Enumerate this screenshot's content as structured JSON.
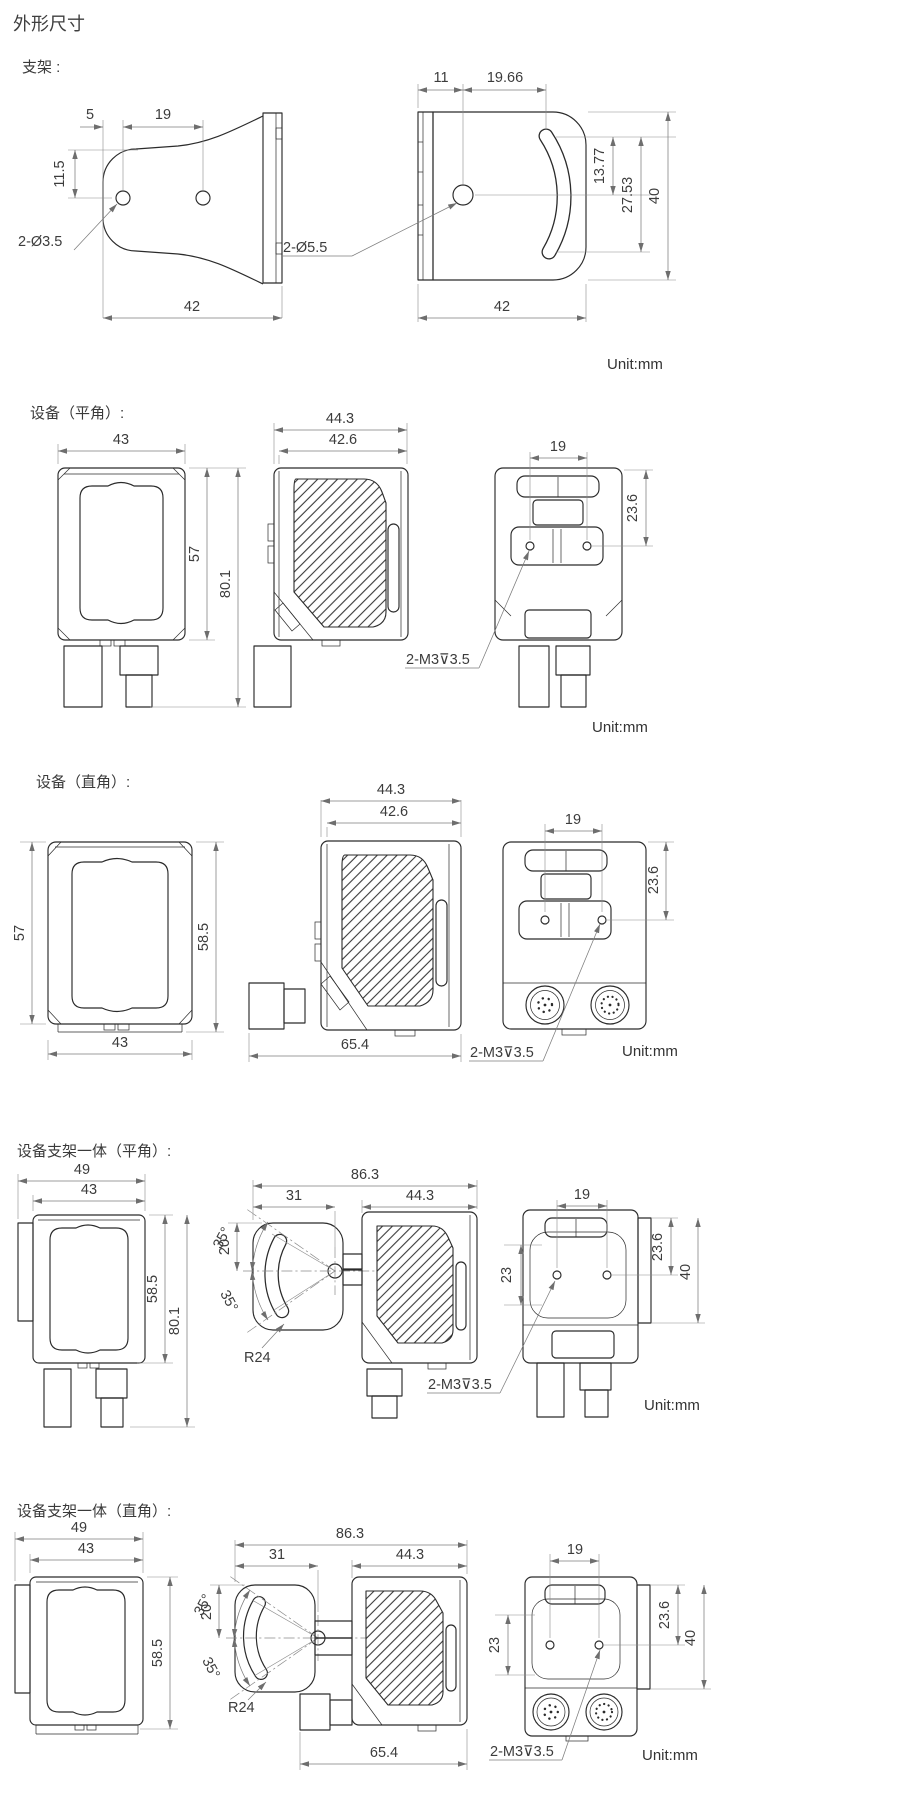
{
  "title": "外形尺寸",
  "unit": "Unit:mm",
  "bracket": {
    "label": "支架 :",
    "side": {
      "off5": "5",
      "sp19": "19",
      "off115": "11.5",
      "holes": "2-Ø3.5",
      "w42": "42"
    },
    "front": {
      "off11": "11",
      "off1966": "19.66",
      "d1377": "13.77",
      "d2753": "27.53",
      "h40": "40",
      "holes": "2-Ø5.5",
      "w42": "42"
    }
  },
  "device_flat": {
    "label": "设备（平角）:",
    "front": {
      "w43": "43",
      "h57": "57",
      "h801": "80.1"
    },
    "side": {
      "d443": "44.3",
      "d426": "42.6"
    },
    "rear": {
      "sp19": "19",
      "off236": "23.6"
    },
    "thread": "2-M3⊽3.5"
  },
  "device_right": {
    "label": "设备（直角）:",
    "front": {
      "h57": "57",
      "h585": "58.5",
      "w43": "43"
    },
    "side": {
      "d443": "44.3",
      "d426": "42.6",
      "l654": "65.4"
    },
    "rear": {
      "sp19": "19",
      "off236": "23.6"
    },
    "thread": "2-M3⊽3.5"
  },
  "combo_flat": {
    "label": "设备支架一体（平角）:",
    "front": {
      "w49": "49",
      "w43": "43",
      "h585": "58.5",
      "h801": "80.1"
    },
    "side": {
      "l863": "86.3",
      "l31": "31",
      "d443": "44.3",
      "a35u": "35°",
      "d20": "20",
      "a35l": "35°",
      "r24": "R24"
    },
    "rear": {
      "sp19": "19",
      "v23": "23",
      "off236": "23.6",
      "h40": "40"
    },
    "thread": "2-M3⊽3.5"
  },
  "combo_right": {
    "label": "设备支架一体（直角）:",
    "front": {
      "w49": "49",
      "w43": "43",
      "h585": "58.5"
    },
    "side": {
      "l863": "86.3",
      "l31": "31",
      "d443": "44.3",
      "a35u": "35°",
      "d20": "20",
      "a35l": "35°",
      "r24": "R24",
      "l654": "65.4"
    },
    "rear": {
      "sp19": "19",
      "v23": "23",
      "off236": "23.6",
      "h40": "40"
    },
    "thread": "2-M3⊽3.5"
  }
}
